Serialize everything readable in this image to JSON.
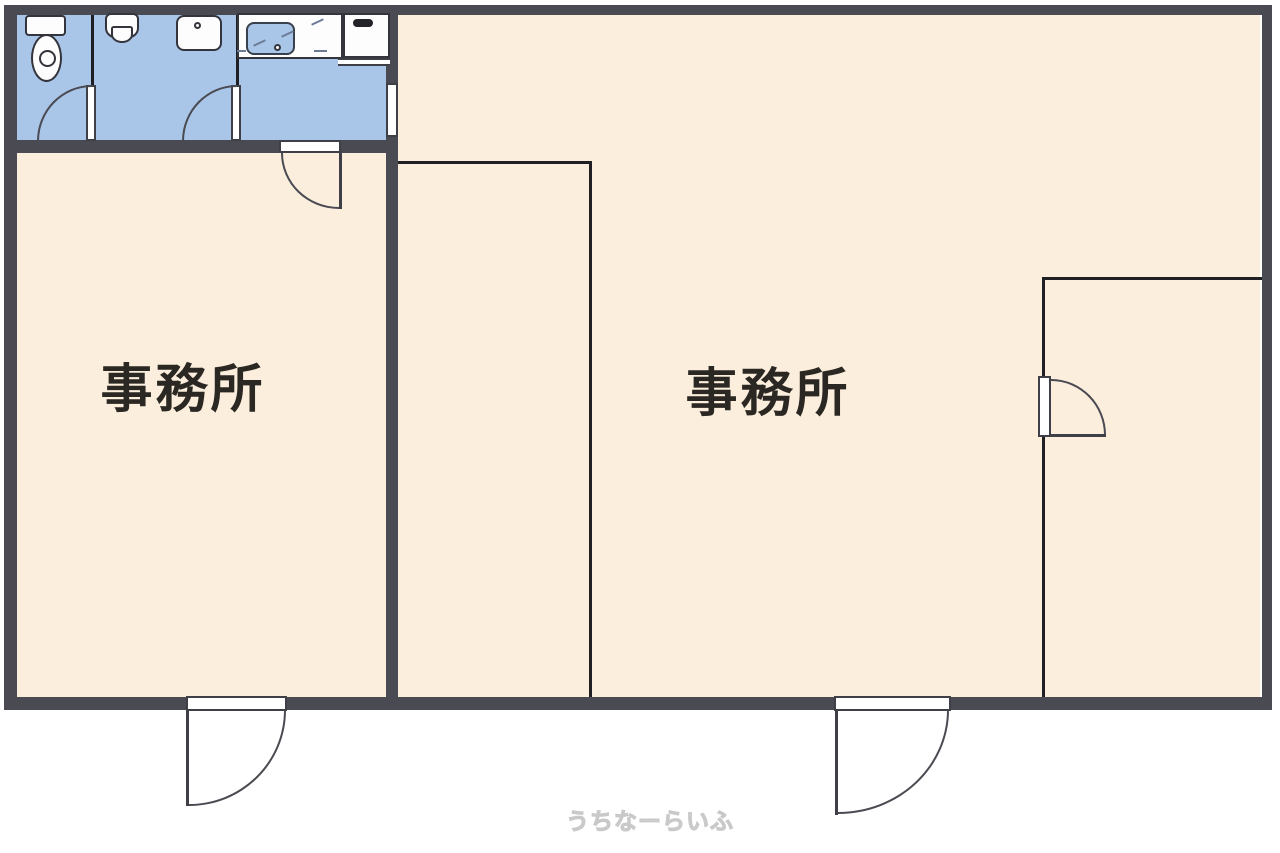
{
  "plan": {
    "type": "floor-plan",
    "rooms": {
      "office_left": {
        "label": "事務所"
      },
      "office_right": {
        "label": "事務所"
      }
    },
    "service_areas": {
      "toilet_compartment": "toilet",
      "washroom_compartment": "urinal-and-washbasin",
      "kitchenette": "counter-with-sink-and-stove"
    },
    "fixtures": [
      "toilet-tank",
      "toilet-bowl",
      "urinal",
      "washbasin",
      "kitchen-sink",
      "stove"
    ],
    "doors": [
      "toilet-door",
      "washroom-door",
      "kitchen-to-office-left-door",
      "kitchen-to-office-right-passage",
      "inner-room-door",
      "entrance-door-left",
      "entrance-door-middle"
    ],
    "colors": {
      "wall": "#4a4a52",
      "floor": "#fbeedd",
      "wet_floor": "#a9c6e8",
      "thin_line": "#1f1f24",
      "label_text": "#2b2722",
      "fixture_fill": "#fdfdfd",
      "fixture_stroke": "#33343c",
      "watermark": "#c9c9c9",
      "background": "#ffffff"
    }
  },
  "watermark": {
    "text": "うちなーらいふ"
  }
}
